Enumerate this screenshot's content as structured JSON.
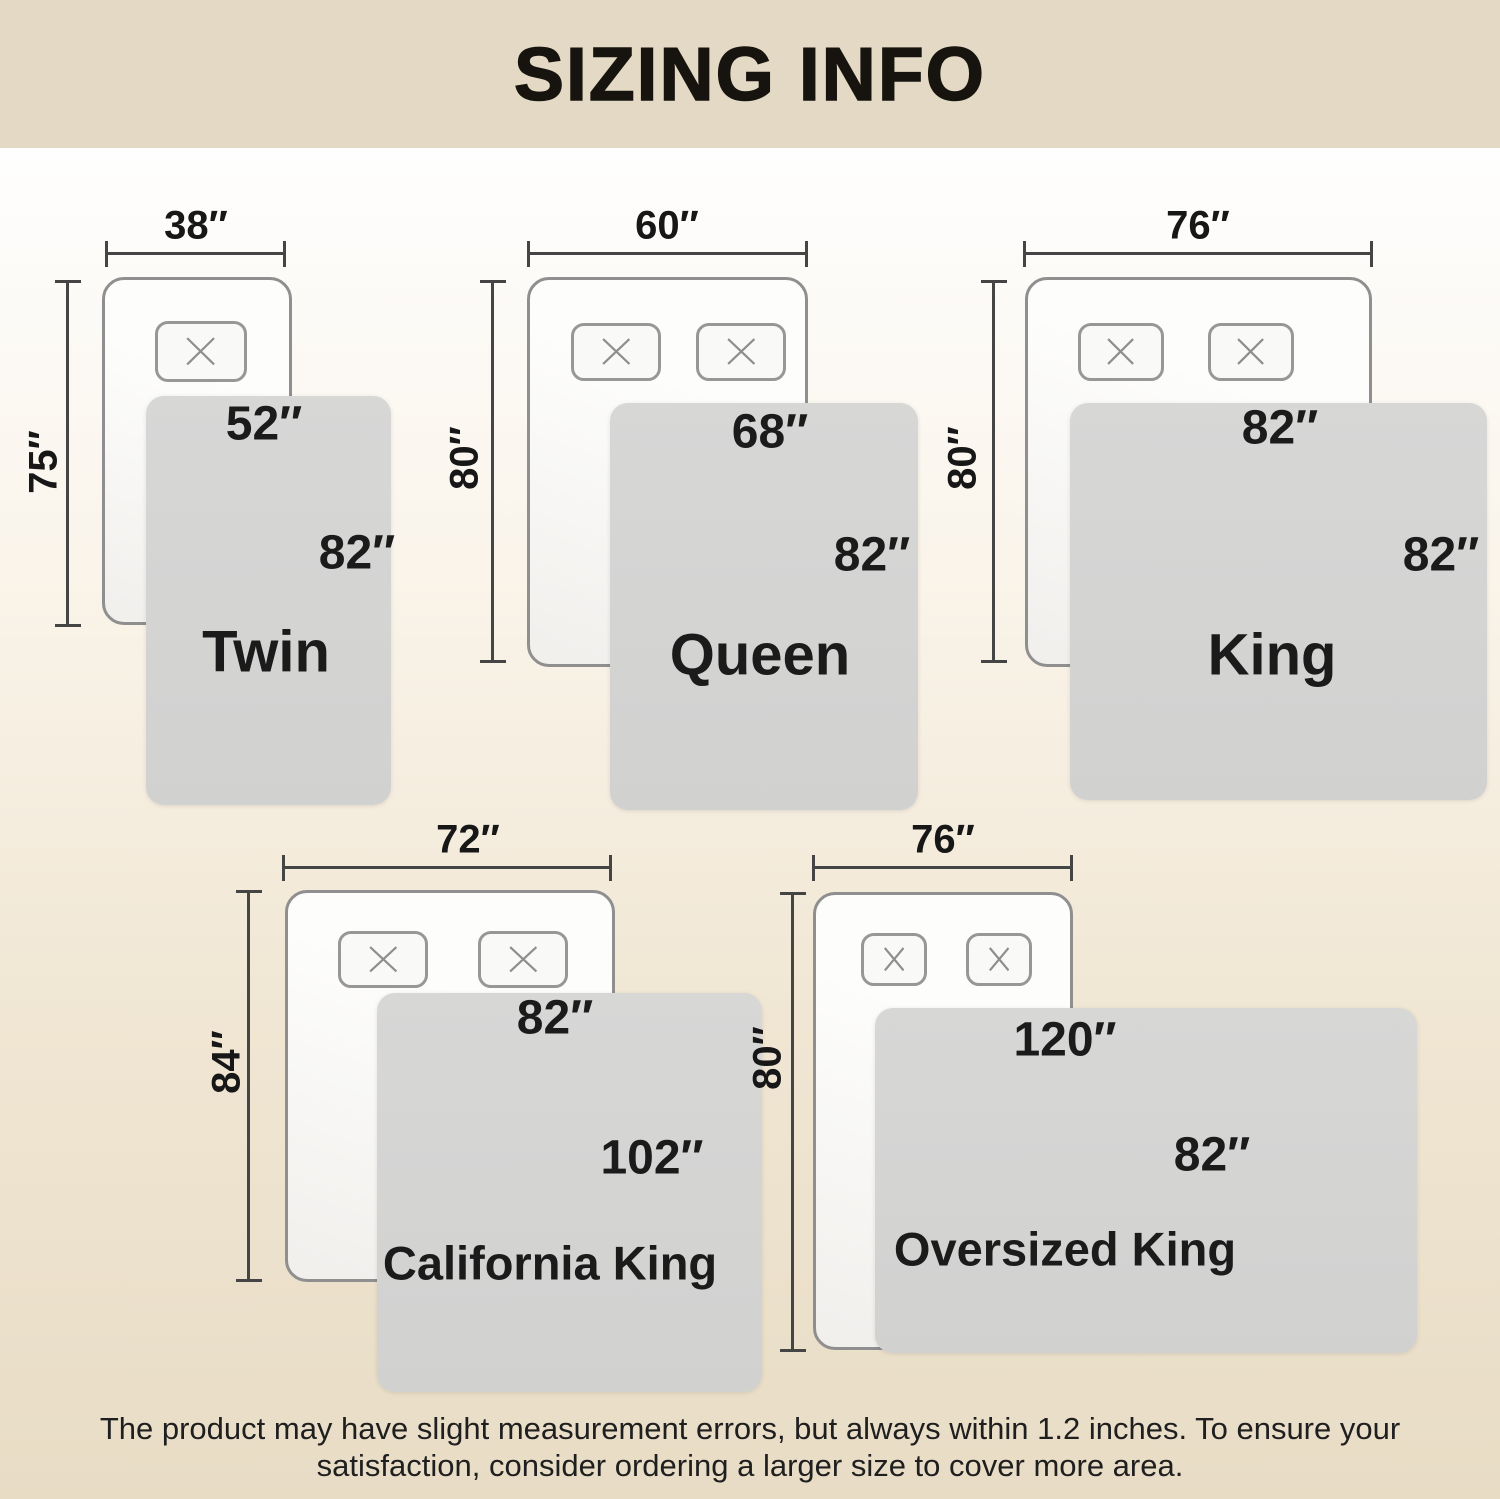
{
  "title": "SIZING INFO",
  "beds": [
    {
      "name": "Twin",
      "mattress_width": "38″",
      "mattress_length": "75″",
      "blanket_width": "52″",
      "blanket_length": "82″"
    },
    {
      "name": "Queen",
      "mattress_width": "60″",
      "mattress_length": "80″",
      "blanket_width": "68″",
      "blanket_length": "82″"
    },
    {
      "name": "King",
      "mattress_width": "76″",
      "mattress_length": "80″",
      "blanket_width": "82″",
      "blanket_length": "82″"
    },
    {
      "name": "California King",
      "mattress_width": "72″",
      "mattress_length": "84″",
      "blanket_width": "82″",
      "blanket_length": "102″"
    },
    {
      "name": "Oversized King",
      "mattress_width": "76″",
      "mattress_length": "80″",
      "blanket_width": "120″",
      "blanket_length": "82″"
    }
  ],
  "footer": {
    "line1": "The product may have slight measurement errors, but always within 1.2 inches. To ensure your",
    "line2": "satisfaction, consider ordering a larger size to cover more area."
  },
  "icons": {
    "pillow_x": "✕"
  },
  "colors": {
    "banner_bg": "#e4d9c4",
    "page_top": "#fefefe",
    "page_bottom": "#e8dcc5",
    "blanket_fill": "#d4d4d3",
    "mattress_border": "#8f8f8f",
    "dimension_line": "#454545",
    "text": "#1b1b1b"
  }
}
